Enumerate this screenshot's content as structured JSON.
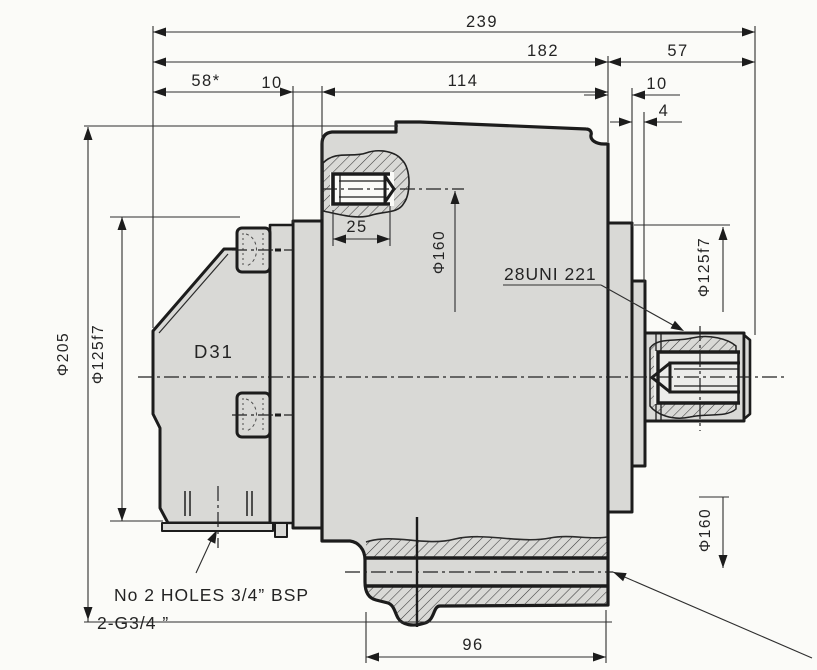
{
  "drawing": {
    "dims": {
      "d239": "239",
      "d182": "182",
      "d57": "57",
      "d58": "58*",
      "d10_left": "10",
      "d114": "114",
      "d10_right": "10",
      "d4": "4",
      "d25": "25",
      "d96": "96"
    },
    "diameters": {
      "phi205": "Φ205",
      "phi125f7_left": "Φ125f7",
      "phi160_top": "Φ160",
      "phi125f7_right": "Φ125f7",
      "phi160_bottom": "Φ160"
    },
    "labels": {
      "d31": "D31",
      "spline": "28UNI 221",
      "note_line1": "No 2 HOLES 3/4”  BSP",
      "note_line2": "2-G3/4  ”"
    },
    "colors": {
      "background": "#fbfbf8",
      "body_fill": "#d9d9d6",
      "outline": "#1c1c1c",
      "dim_line": "#2e2e2e",
      "hatch": "#3c3c3c"
    }
  }
}
